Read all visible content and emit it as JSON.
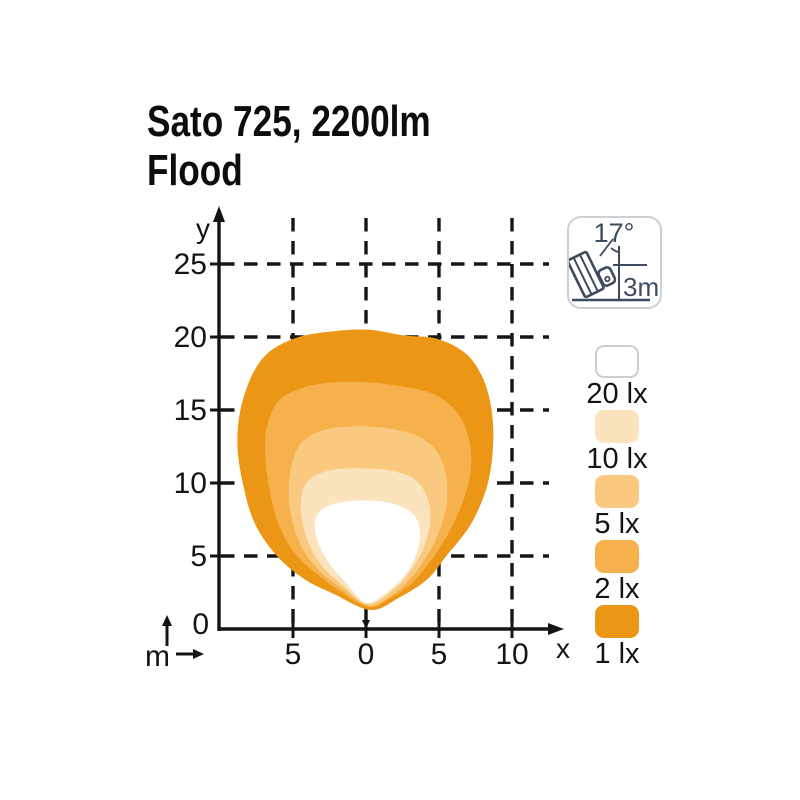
{
  "title": {
    "line1": "Sato 725, 2200lm",
    "line2": "Flood"
  },
  "mount_icon": {
    "angle_label": "17°",
    "height_label": "3m"
  },
  "legend": {
    "items": [
      {
        "label": "20 lx",
        "color_key": "lx20"
      },
      {
        "label": "10 lx",
        "color_key": "lx10"
      },
      {
        "label": "5 lx",
        "color_key": "lx5"
      },
      {
        "label": "2 lx",
        "color_key": "lx2"
      },
      {
        "label": "1 lx",
        "color_key": "lx1"
      }
    ]
  },
  "colors": {
    "lx20": "#FFFFFF",
    "lx10": "#FBE3BE",
    "lx5": "#F9C97F",
    "lx2": "#F6B04C",
    "lx1": "#EC9616",
    "swatch_border": "#C9CED3",
    "icon_stroke": "#3C4C5E",
    "axis": "#141414"
  },
  "chart_data": {
    "type": "area",
    "title": "Isolux beam pattern, Sato 725 Flood 2200lm",
    "xlabel": "x",
    "ylabel": "y",
    "unit_label": "m",
    "origin_label": "0",
    "grid": true,
    "xlim": [
      -10.2,
      13.5
    ],
    "ylim": [
      0,
      28.5
    ],
    "max_reach_m": 20.5,
    "max_width_m": 17.5,
    "x_ticks": [
      {
        "value": -5,
        "label": "5"
      },
      {
        "value": 0,
        "label": "0"
      },
      {
        "value": 5,
        "label": "5"
      },
      {
        "value": 10,
        "label": "10"
      }
    ],
    "y_ticks": [
      {
        "value": 5,
        "label": "5"
      },
      {
        "value": 10,
        "label": "10"
      },
      {
        "value": 15,
        "label": "15"
      },
      {
        "value": 20,
        "label": "20"
      },
      {
        "value": 25,
        "label": "25"
      }
    ],
    "pixel_mapping": {
      "origin_px": [
        366,
        629
      ],
      "px_per_m": 14.6
    },
    "series": [
      {
        "name": "1 lx",
        "lux": 1,
        "color_key": "lx1",
        "outline_m": [
          [
            0.3,
            1.3
          ],
          [
            -2.2,
            2.4
          ],
          [
            -4.2,
            3.4
          ],
          [
            -6.1,
            5.0
          ],
          [
            -7.6,
            7.2
          ],
          [
            -8.4,
            9.8
          ],
          [
            -8.8,
            12.5
          ],
          [
            -8.6,
            15.0
          ],
          [
            -7.8,
            17.4
          ],
          [
            -6.6,
            19.0
          ],
          [
            -4.6,
            20.0
          ],
          [
            -2.2,
            20.4
          ],
          [
            0.2,
            20.5
          ],
          [
            2.6,
            20.1
          ],
          [
            4.8,
            19.9
          ],
          [
            6.8,
            18.9
          ],
          [
            8.0,
            17.2
          ],
          [
            8.6,
            15.0
          ],
          [
            8.7,
            12.5
          ],
          [
            8.3,
            9.8
          ],
          [
            7.2,
            7.2
          ],
          [
            5.5,
            5.0
          ],
          [
            4.2,
            3.4
          ],
          [
            2.2,
            2.1
          ]
        ]
      },
      {
        "name": "2 lx",
        "lux": 2,
        "color_key": "lx2",
        "outline_m": [
          [
            0.2,
            1.5
          ],
          [
            -1.8,
            2.6
          ],
          [
            -3.4,
            3.8
          ],
          [
            -4.9,
            5.2
          ],
          [
            -6.0,
            7.2
          ],
          [
            -6.6,
            9.5
          ],
          [
            -6.9,
            11.8
          ],
          [
            -6.8,
            13.8
          ],
          [
            -6.0,
            15.6
          ],
          [
            -4.4,
            16.5
          ],
          [
            -2.2,
            16.9
          ],
          [
            0.2,
            16.9
          ],
          [
            2.6,
            16.6
          ],
          [
            4.6,
            16.1
          ],
          [
            6.2,
            14.9
          ],
          [
            7.0,
            13.2
          ],
          [
            7.2,
            11.2
          ],
          [
            6.8,
            9.2
          ],
          [
            5.9,
            7.0
          ],
          [
            4.6,
            4.9
          ],
          [
            3.2,
            3.2
          ],
          [
            1.8,
            2.2
          ]
        ]
      },
      {
        "name": "5 lx",
        "lux": 5,
        "color_key": "lx5",
        "outline_m": [
          [
            0.2,
            1.6
          ],
          [
            -1.7,
            2.8
          ],
          [
            -3.2,
            4.0
          ],
          [
            -4.4,
            5.6
          ],
          [
            -5.1,
            7.6
          ],
          [
            -5.3,
            9.6
          ],
          [
            -5.0,
            11.6
          ],
          [
            -4.2,
            13.0
          ],
          [
            -2.6,
            13.7
          ],
          [
            -0.4,
            13.9
          ],
          [
            1.8,
            13.7
          ],
          [
            3.6,
            13.2
          ],
          [
            4.9,
            12.1
          ],
          [
            5.5,
            10.4
          ],
          [
            5.5,
            8.4
          ],
          [
            4.9,
            6.4
          ],
          [
            4.0,
            4.7
          ],
          [
            2.8,
            3.2
          ],
          [
            1.6,
            2.2
          ]
        ]
      },
      {
        "name": "10 lx",
        "lux": 10,
        "color_key": "lx10",
        "outline_m": [
          [
            0.1,
            1.7
          ],
          [
            -1.6,
            3.0
          ],
          [
            -3.0,
            4.3
          ],
          [
            -3.9,
            5.8
          ],
          [
            -4.4,
            7.6
          ],
          [
            -4.4,
            9.2
          ],
          [
            -3.8,
            10.3
          ],
          [
            -2.3,
            10.9
          ],
          [
            -0.2,
            11.0
          ],
          [
            1.9,
            10.8
          ],
          [
            3.4,
            10.2
          ],
          [
            4.2,
            9.0
          ],
          [
            4.4,
            7.4
          ],
          [
            4.0,
            5.7
          ],
          [
            3.2,
            4.2
          ],
          [
            2.0,
            2.8
          ]
        ]
      },
      {
        "name": "20 lx",
        "lux": 20,
        "color_key": "lx20",
        "outline_m": [
          [
            0.0,
            1.8
          ],
          [
            -1.4,
            3.2
          ],
          [
            -2.6,
            4.6
          ],
          [
            -3.3,
            6.0
          ],
          [
            -3.5,
            7.3
          ],
          [
            -3.0,
            8.2
          ],
          [
            -1.6,
            8.7
          ],
          [
            0.3,
            8.8
          ],
          [
            2.1,
            8.5
          ],
          [
            3.3,
            7.8
          ],
          [
            3.7,
            6.5
          ],
          [
            3.4,
            5.0
          ],
          [
            2.6,
            3.6
          ],
          [
            1.4,
            2.5
          ]
        ]
      }
    ]
  }
}
